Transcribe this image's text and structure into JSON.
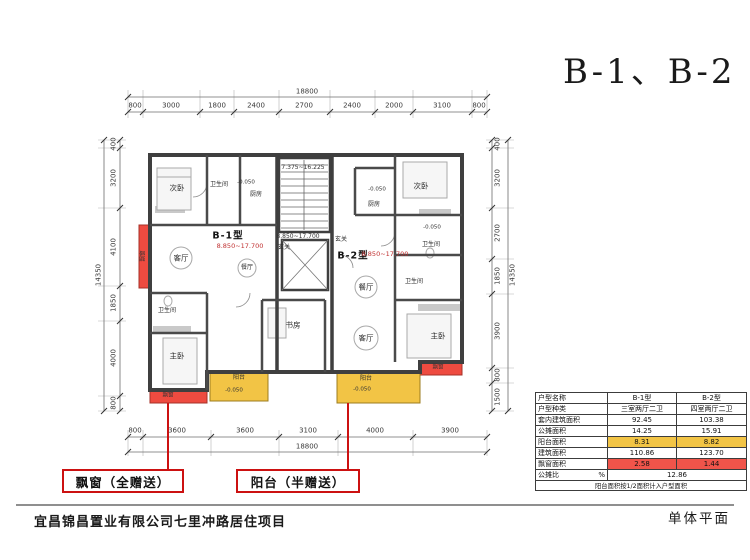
{
  "title": "B-1、B-2",
  "footer": {
    "project_name": "宜昌锦昌置业有限公司七里冲路居住项目",
    "sheet_name": "单体平面"
  },
  "callouts": {
    "bay_window": "飘窗（全赠送）",
    "balcony": "阳台（半赠送）"
  },
  "plan": {
    "unit_b1_name": "B-1型",
    "unit_b1_levels": "8.850~17.700",
    "unit_b2_name": "B-2型",
    "unit_b2_levels": "8.850~17.700",
    "stair_levels": "7.375~16.225",
    "corridor_levels": "8.850~17.700",
    "floor_level": "-0.050",
    "rooms": {
      "bedroom2": "次卧",
      "master_bedroom": "主卧",
      "living": "客厅",
      "dining": "餐厅",
      "kitchen": "厨房",
      "bathroom": "卫生间",
      "study": "书房",
      "entry": "玄关",
      "balcony": "阳台",
      "bay_window": "飘窗"
    },
    "dims": {
      "top_total": "18800",
      "top": [
        "800",
        "3000",
        "1800",
        "2400",
        "2700",
        "2400",
        "2000",
        "3100",
        "800"
      ],
      "bottom_total": "18800",
      "bottom": [
        "800",
        "3600",
        "3600",
        "3100",
        "4000",
        "3900"
      ],
      "left_total": "14350",
      "left": [
        "400",
        "3200",
        "4100",
        "1850",
        "4000",
        "800"
      ],
      "right_total": "14350",
      "right": [
        "400",
        "3200",
        "2700",
        "1850",
        "3900",
        "800",
        "1500"
      ]
    }
  },
  "table": {
    "header": {
      "name": "户型名称",
      "b1": "B-1型",
      "b2": "B-2型"
    },
    "rows": [
      {
        "label": "户型种类",
        "b1": "三室两厅二卫",
        "b2": "四室两厅二卫"
      },
      {
        "label": "套内建筑面积",
        "b1": "92.45",
        "b2": "103.38"
      },
      {
        "label": "公摊面积",
        "b1": "14.25",
        "b2": "15.91"
      },
      {
        "label": "阳台面积",
        "b1": "8.31",
        "b2": "8.82"
      },
      {
        "label": "建筑面积",
        "b1": "110.86",
        "b2": "123.70"
      },
      {
        "label": "飘窗面积",
        "b1": "2.58",
        "b2": "1.44"
      }
    ],
    "ratio_label": "公摊比",
    "ratio_unit": "%",
    "ratio_value": "12.86",
    "note": "阳台面积按1/2面积计入户型面积"
  },
  "colors": {
    "balcony_highlight": "#f2c445",
    "bay_window_highlight": "#ee4b40",
    "callout_red": "#cc1111",
    "level_text_red": "#c03030"
  }
}
